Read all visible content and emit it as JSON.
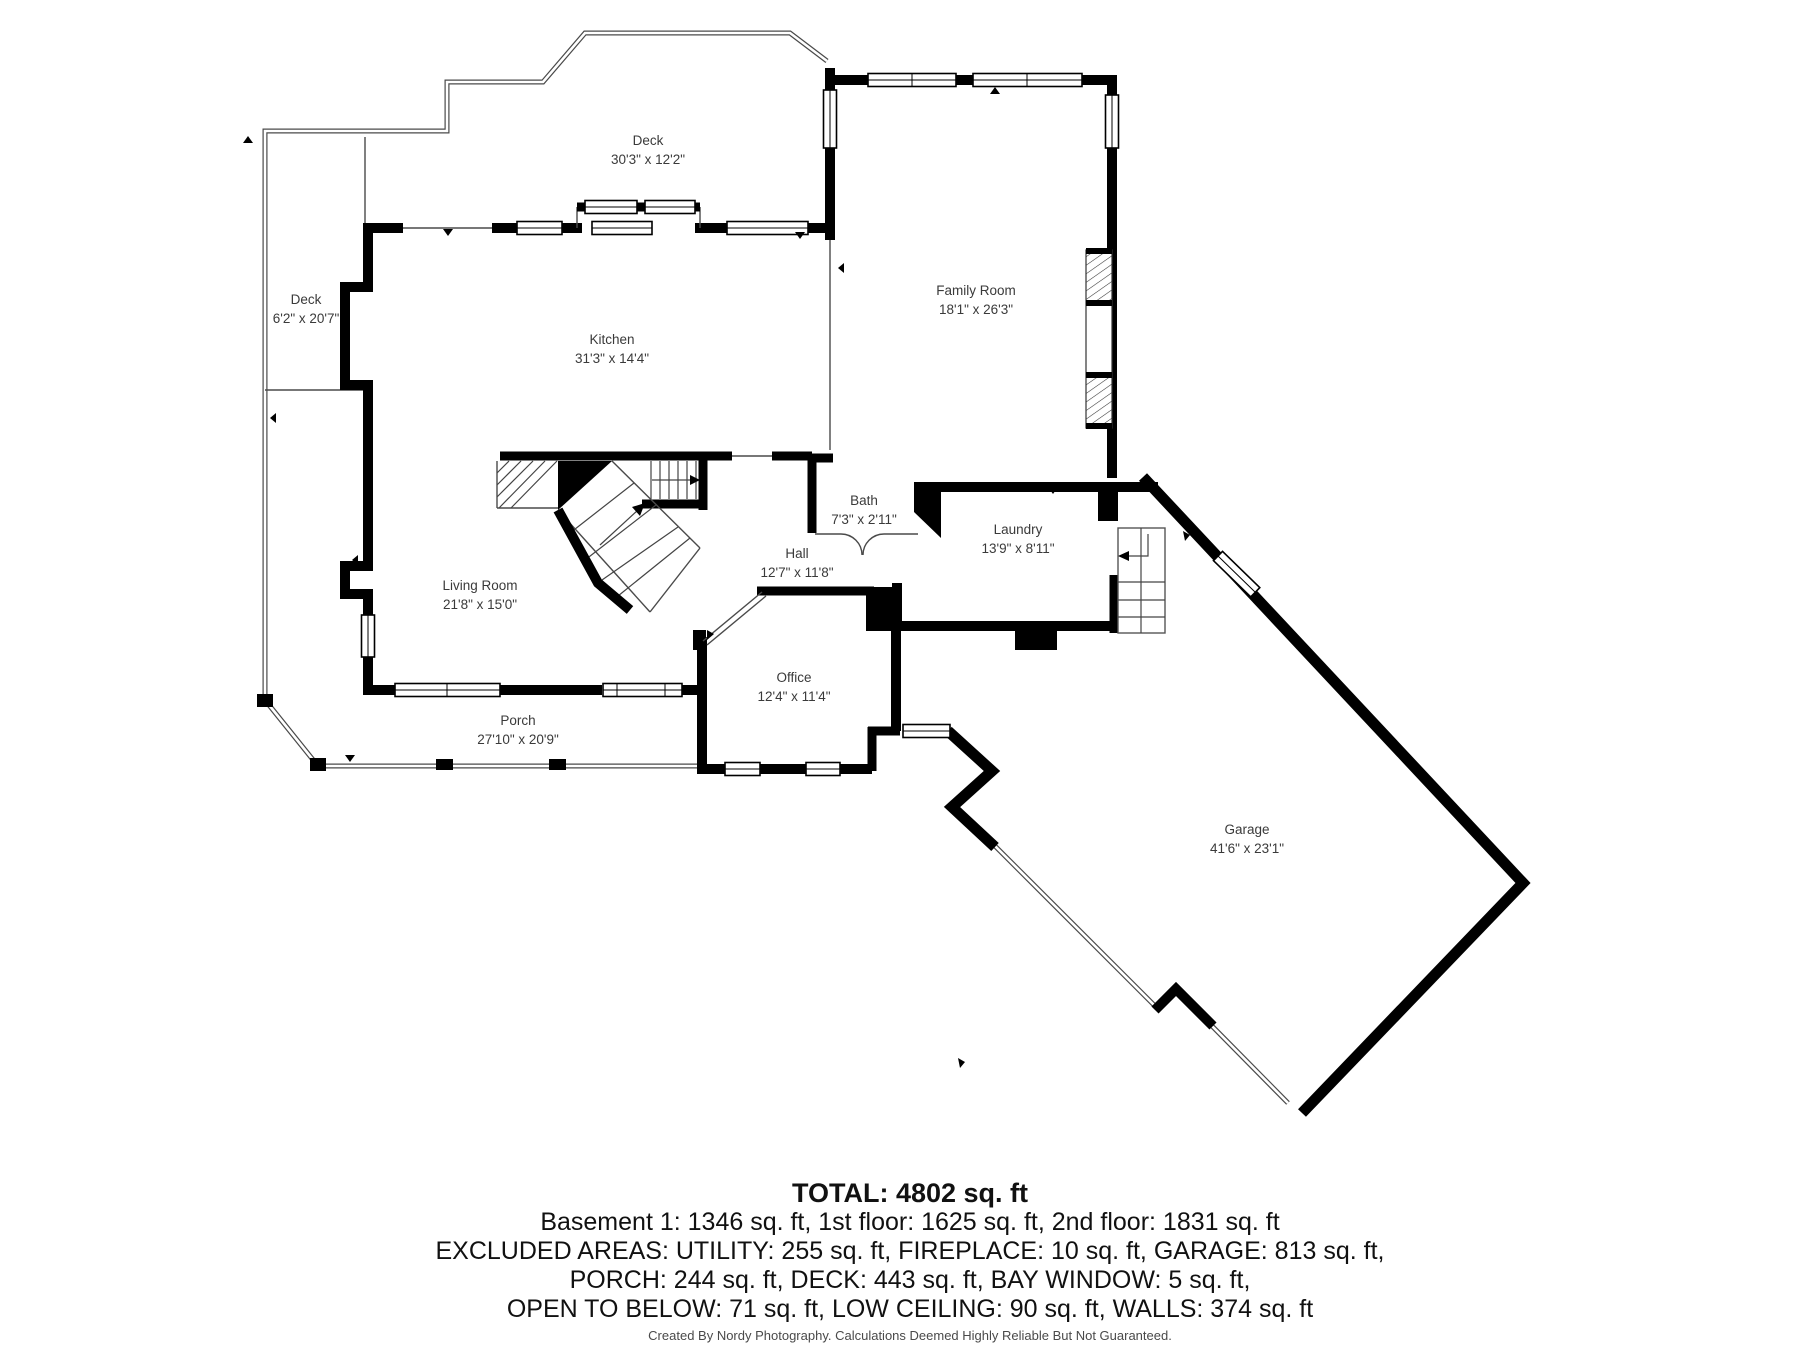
{
  "page": {
    "background": "#ffffff",
    "wall_color": "#000000",
    "railing_color": "#4a4a4a",
    "label_color": "#3a3a3a"
  },
  "rooms": [
    {
      "id": "deck-top",
      "name": "Deck",
      "dims": "30'3\" x 12'2\""
    },
    {
      "id": "deck-left",
      "name": "Deck",
      "dims": "6'2\" x 20'7\""
    },
    {
      "id": "kitchen",
      "name": "Kitchen",
      "dims": "31'3\" x 14'4\""
    },
    {
      "id": "family-room",
      "name": "Family Room",
      "dims": "18'1\" x 26'3\""
    },
    {
      "id": "bath",
      "name": "Bath",
      "dims": "7'3\" x 2'11\""
    },
    {
      "id": "laundry",
      "name": "Laundry",
      "dims": "13'9\" x 8'11\""
    },
    {
      "id": "hall",
      "name": "Hall",
      "dims": "12'7\" x 11'8\""
    },
    {
      "id": "living-room",
      "name": "Living Room",
      "dims": "21'8\" x 15'0\""
    },
    {
      "id": "office",
      "name": "Office",
      "dims": "12'4\" x 11'4\""
    },
    {
      "id": "porch",
      "name": "Porch",
      "dims": "27'10\" x 20'9\""
    },
    {
      "id": "garage",
      "name": "Garage",
      "dims": "41'6\" x 23'1\""
    }
  ],
  "summary": {
    "total": "TOTAL: 4802 sq. ft",
    "floors": "Basement 1: 1346 sq. ft, 1st floor: 1625 sq. ft, 2nd floor: 1831 sq. ft",
    "excluded1": "EXCLUDED AREAS: UTILITY: 255 sq. ft, FIREPLACE: 10 sq. ft, GARAGE: 813 sq. ft,",
    "excluded2": "PORCH: 244 sq. ft, DECK: 443 sq. ft, BAY WINDOW: 5 sq. ft,",
    "excluded3": "OPEN TO BELOW: 71 sq. ft, LOW CEILING: 90 sq. ft, WALLS: 374 sq. ft"
  },
  "footer": "Created By Nordy Photography. Calculations Deemed Highly Reliable But Not Guaranteed."
}
